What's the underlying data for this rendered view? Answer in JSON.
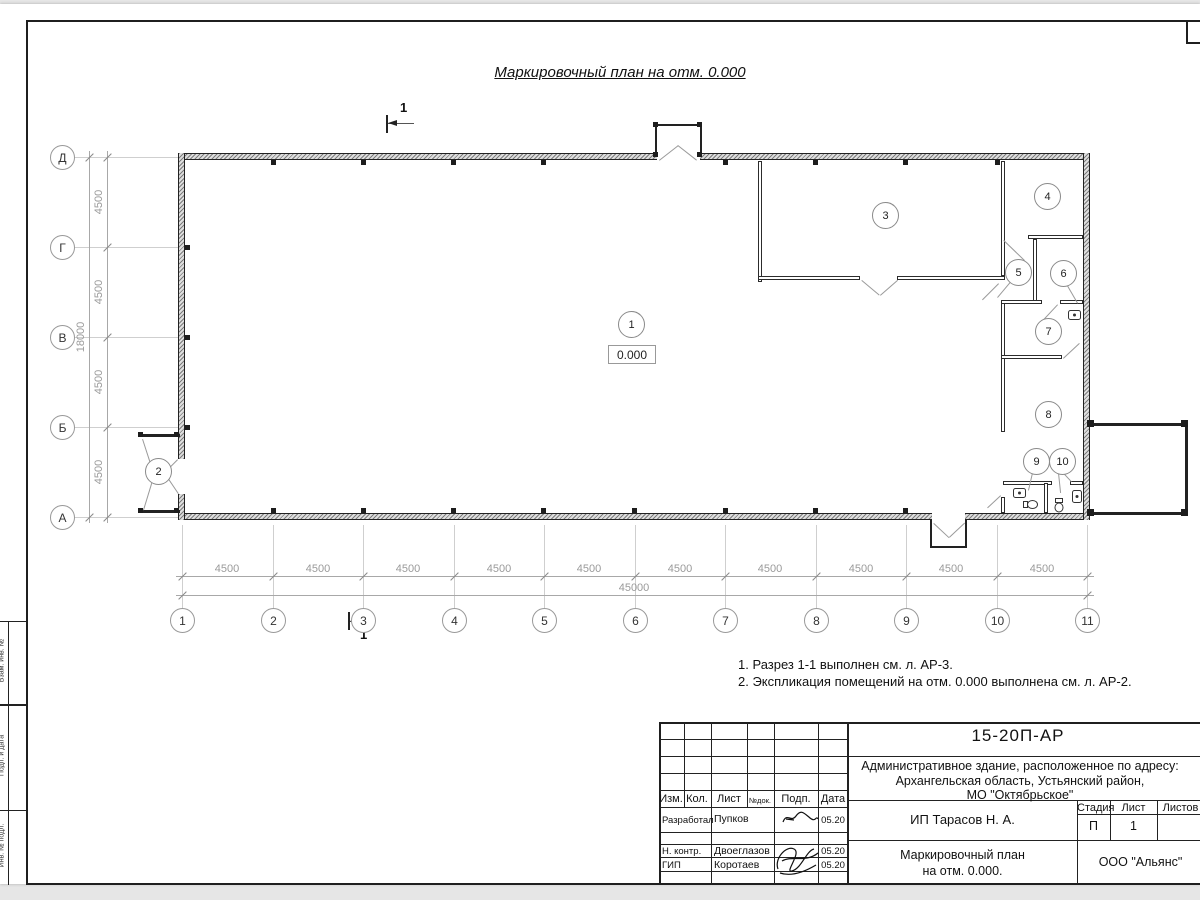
{
  "page": {
    "title": "Маркировочный план на отм. 0.000",
    "notes": [
      "1. Разрез 1-1 выполнен см. л. АР-3.",
      "2. Экспликация помещений на отм. 0.000 выполнена см. л. АР-2."
    ]
  },
  "plan": {
    "elevation_mark": "0.000",
    "section_label": "1",
    "rooms": [
      "1",
      "2",
      "3",
      "4",
      "5",
      "6",
      "7",
      "8",
      "9",
      "10"
    ],
    "axes_vertical": [
      "Д",
      "Г",
      "В",
      "Б",
      "А"
    ],
    "axes_horizontal": [
      "1",
      "2",
      "3",
      "4",
      "5",
      "6",
      "7",
      "8",
      "9",
      "10",
      "11"
    ],
    "dims_left_segments": [
      "4500",
      "4500",
      "4500",
      "4500"
    ],
    "dims_left_total": "18000",
    "dims_bottom_segments": [
      "4500",
      "4500",
      "4500",
      "4500",
      "4500",
      "4500",
      "4500",
      "4500",
      "4500",
      "4500"
    ],
    "dims_bottom_total": "45000"
  },
  "frame": {
    "side_labels": [
      "Взам. инв. №",
      "Подп. и дата",
      "Инв. № подл."
    ]
  },
  "titleblock": {
    "doc_number": "15-20П-АР",
    "object_lines": [
      "Административное здание, расположенное по адресу:",
      "Архангельская область, Устьянский район,",
      "МО \"Октябрьское\""
    ],
    "header_cols": [
      "Изм.",
      "Кол.",
      "Лист",
      "№док.",
      "Подп.",
      "Дата"
    ],
    "rows": [
      {
        "role": "Разработал",
        "name": "Пупков",
        "date": "05.20"
      },
      {
        "role": "Н. контр.",
        "name": "Двоеглазов",
        "date": "05.20"
      },
      {
        "role": "ГИП",
        "name": "Коротаев",
        "date": "05.20"
      }
    ],
    "client": "ИП Тарасов Н. А.",
    "stage_label": "Стадия",
    "sheet_label": "Лист",
    "sheets_label": "Листов",
    "stage": "П",
    "sheet": "1",
    "drawing_title_lines": [
      "Маркировочный план",
      "на отм. 0.000."
    ],
    "company": "ООО \"Альянс\""
  }
}
